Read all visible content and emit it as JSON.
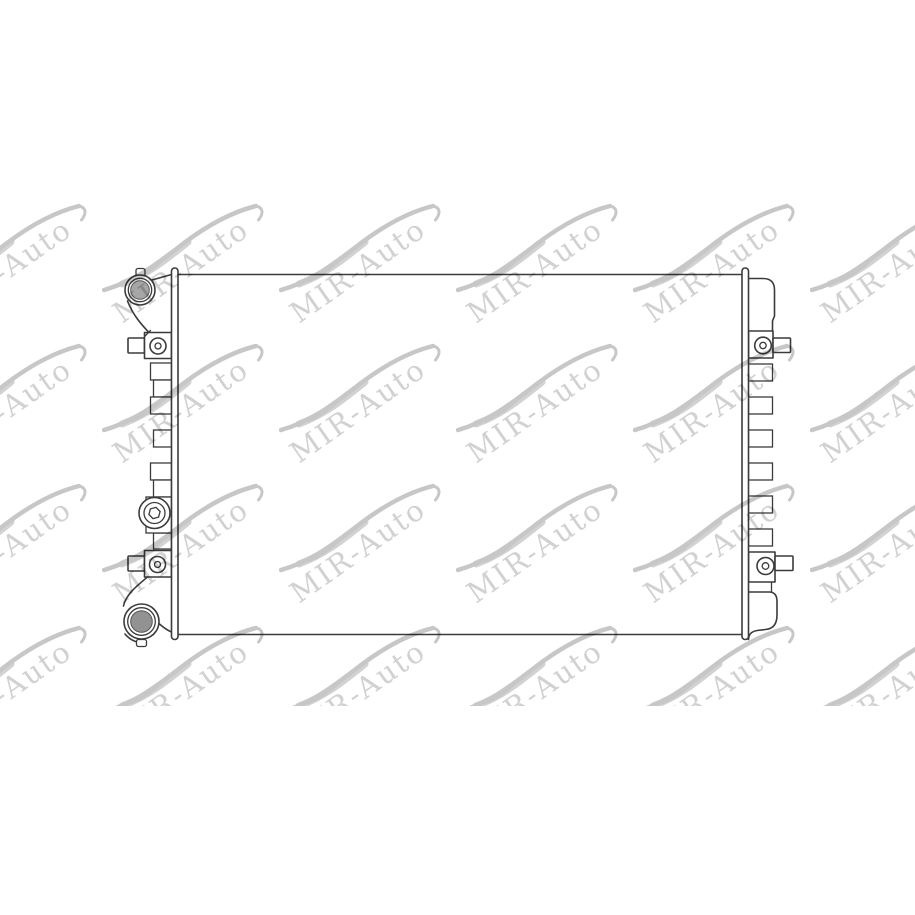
{
  "page": {
    "background": "#ffffff",
    "alt": "Technical line drawing of an automobile radiator, front view, with repeated MIR-Auto watermarks"
  },
  "drawing": {
    "line_color": "#3b3b3b",
    "cap_fill": "#a6a6a6",
    "outlet_fill": "#929292"
  },
  "watermark": {
    "text": "MIR-Auto",
    "text_color": "#c9c9c9",
    "swoosh_color": "#b4b4b4",
    "angle_deg": -35,
    "band_height": 706,
    "rows": [
      190,
      330,
      470,
      612
    ],
    "cols": [
      -75,
      102,
      279,
      456,
      633,
      810
    ]
  }
}
